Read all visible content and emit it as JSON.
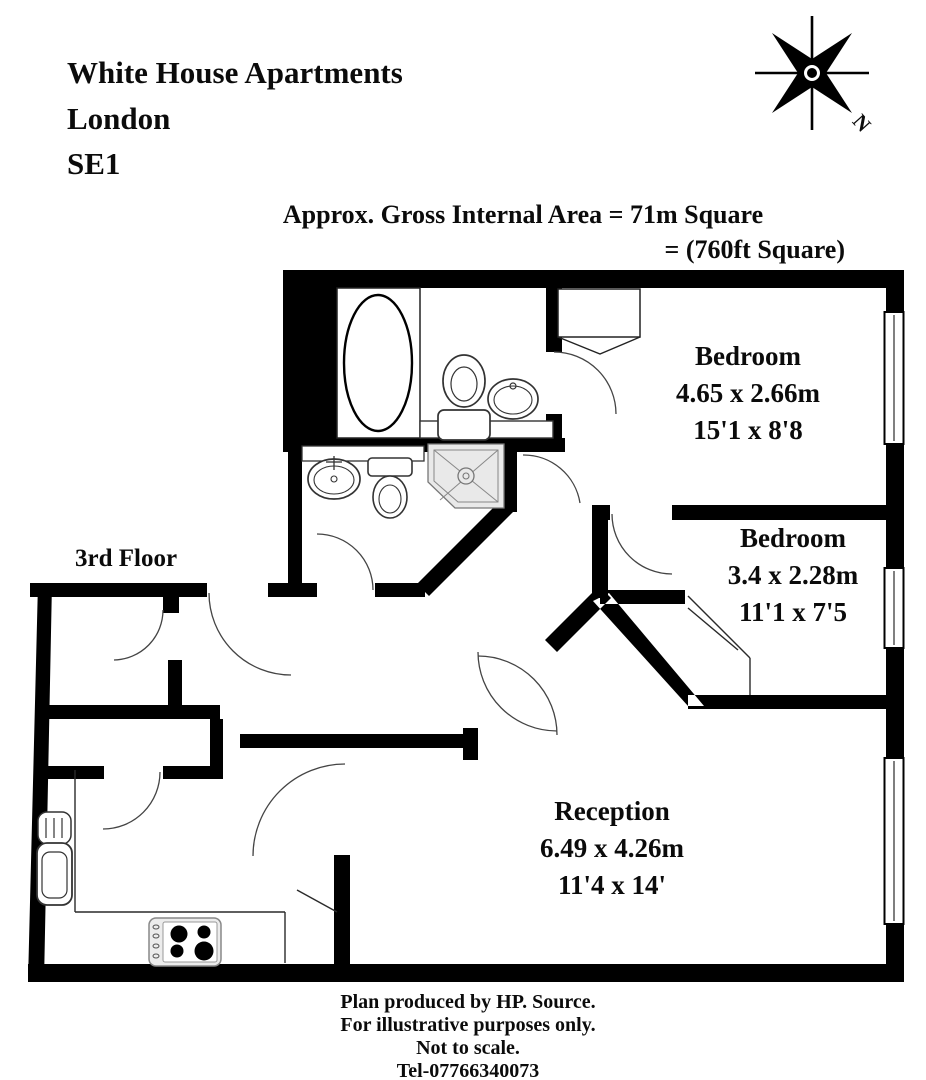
{
  "title": {
    "line1": "White House Apartments",
    "line2": "London",
    "line3": "SE1"
  },
  "area_note": {
    "line1": "Approx. Gross Internal Area = 71m Square",
    "line2": "= (760ft Square)"
  },
  "floor_label": "3rd Floor",
  "compass": {
    "north_label": "N"
  },
  "rooms": [
    {
      "name": "Bedroom",
      "dimensions_m": "4.65 x 2.66m",
      "dimensions_ft": "15'1 x 8'8"
    },
    {
      "name": "Bedroom",
      "dimensions_m": "3.4 x 2.28m",
      "dimensions_ft": "11'1 x 7'5"
    },
    {
      "name": "Reception",
      "dimensions_m": "6.49 x 4.26m",
      "dimensions_ft": "11'4 x 14'"
    }
  ],
  "fixtures": {
    "bathroom": [
      "bathtub",
      "toilet",
      "sink",
      "vanity-counter"
    ],
    "ensuite": [
      "sink",
      "toilet",
      "shower"
    ],
    "kitchen": [
      "sink-drainer",
      "hob"
    ],
    "bedroom1": [
      "wardrobe"
    ]
  },
  "windows": {
    "count": 3,
    "locations": [
      "bedroom-1 right wall",
      "bedroom-2 right wall",
      "reception right wall"
    ]
  },
  "footer": {
    "line1": "Plan produced by HP. Source.",
    "line2": "For illustrative purposes only.",
    "line3": "Not to scale.",
    "line4": "Tel-07766340073"
  },
  "colors": {
    "walls": "#000000",
    "background": "#ffffff",
    "fixture_fill": "#ebebeb",
    "text": "#0b0b0b"
  }
}
